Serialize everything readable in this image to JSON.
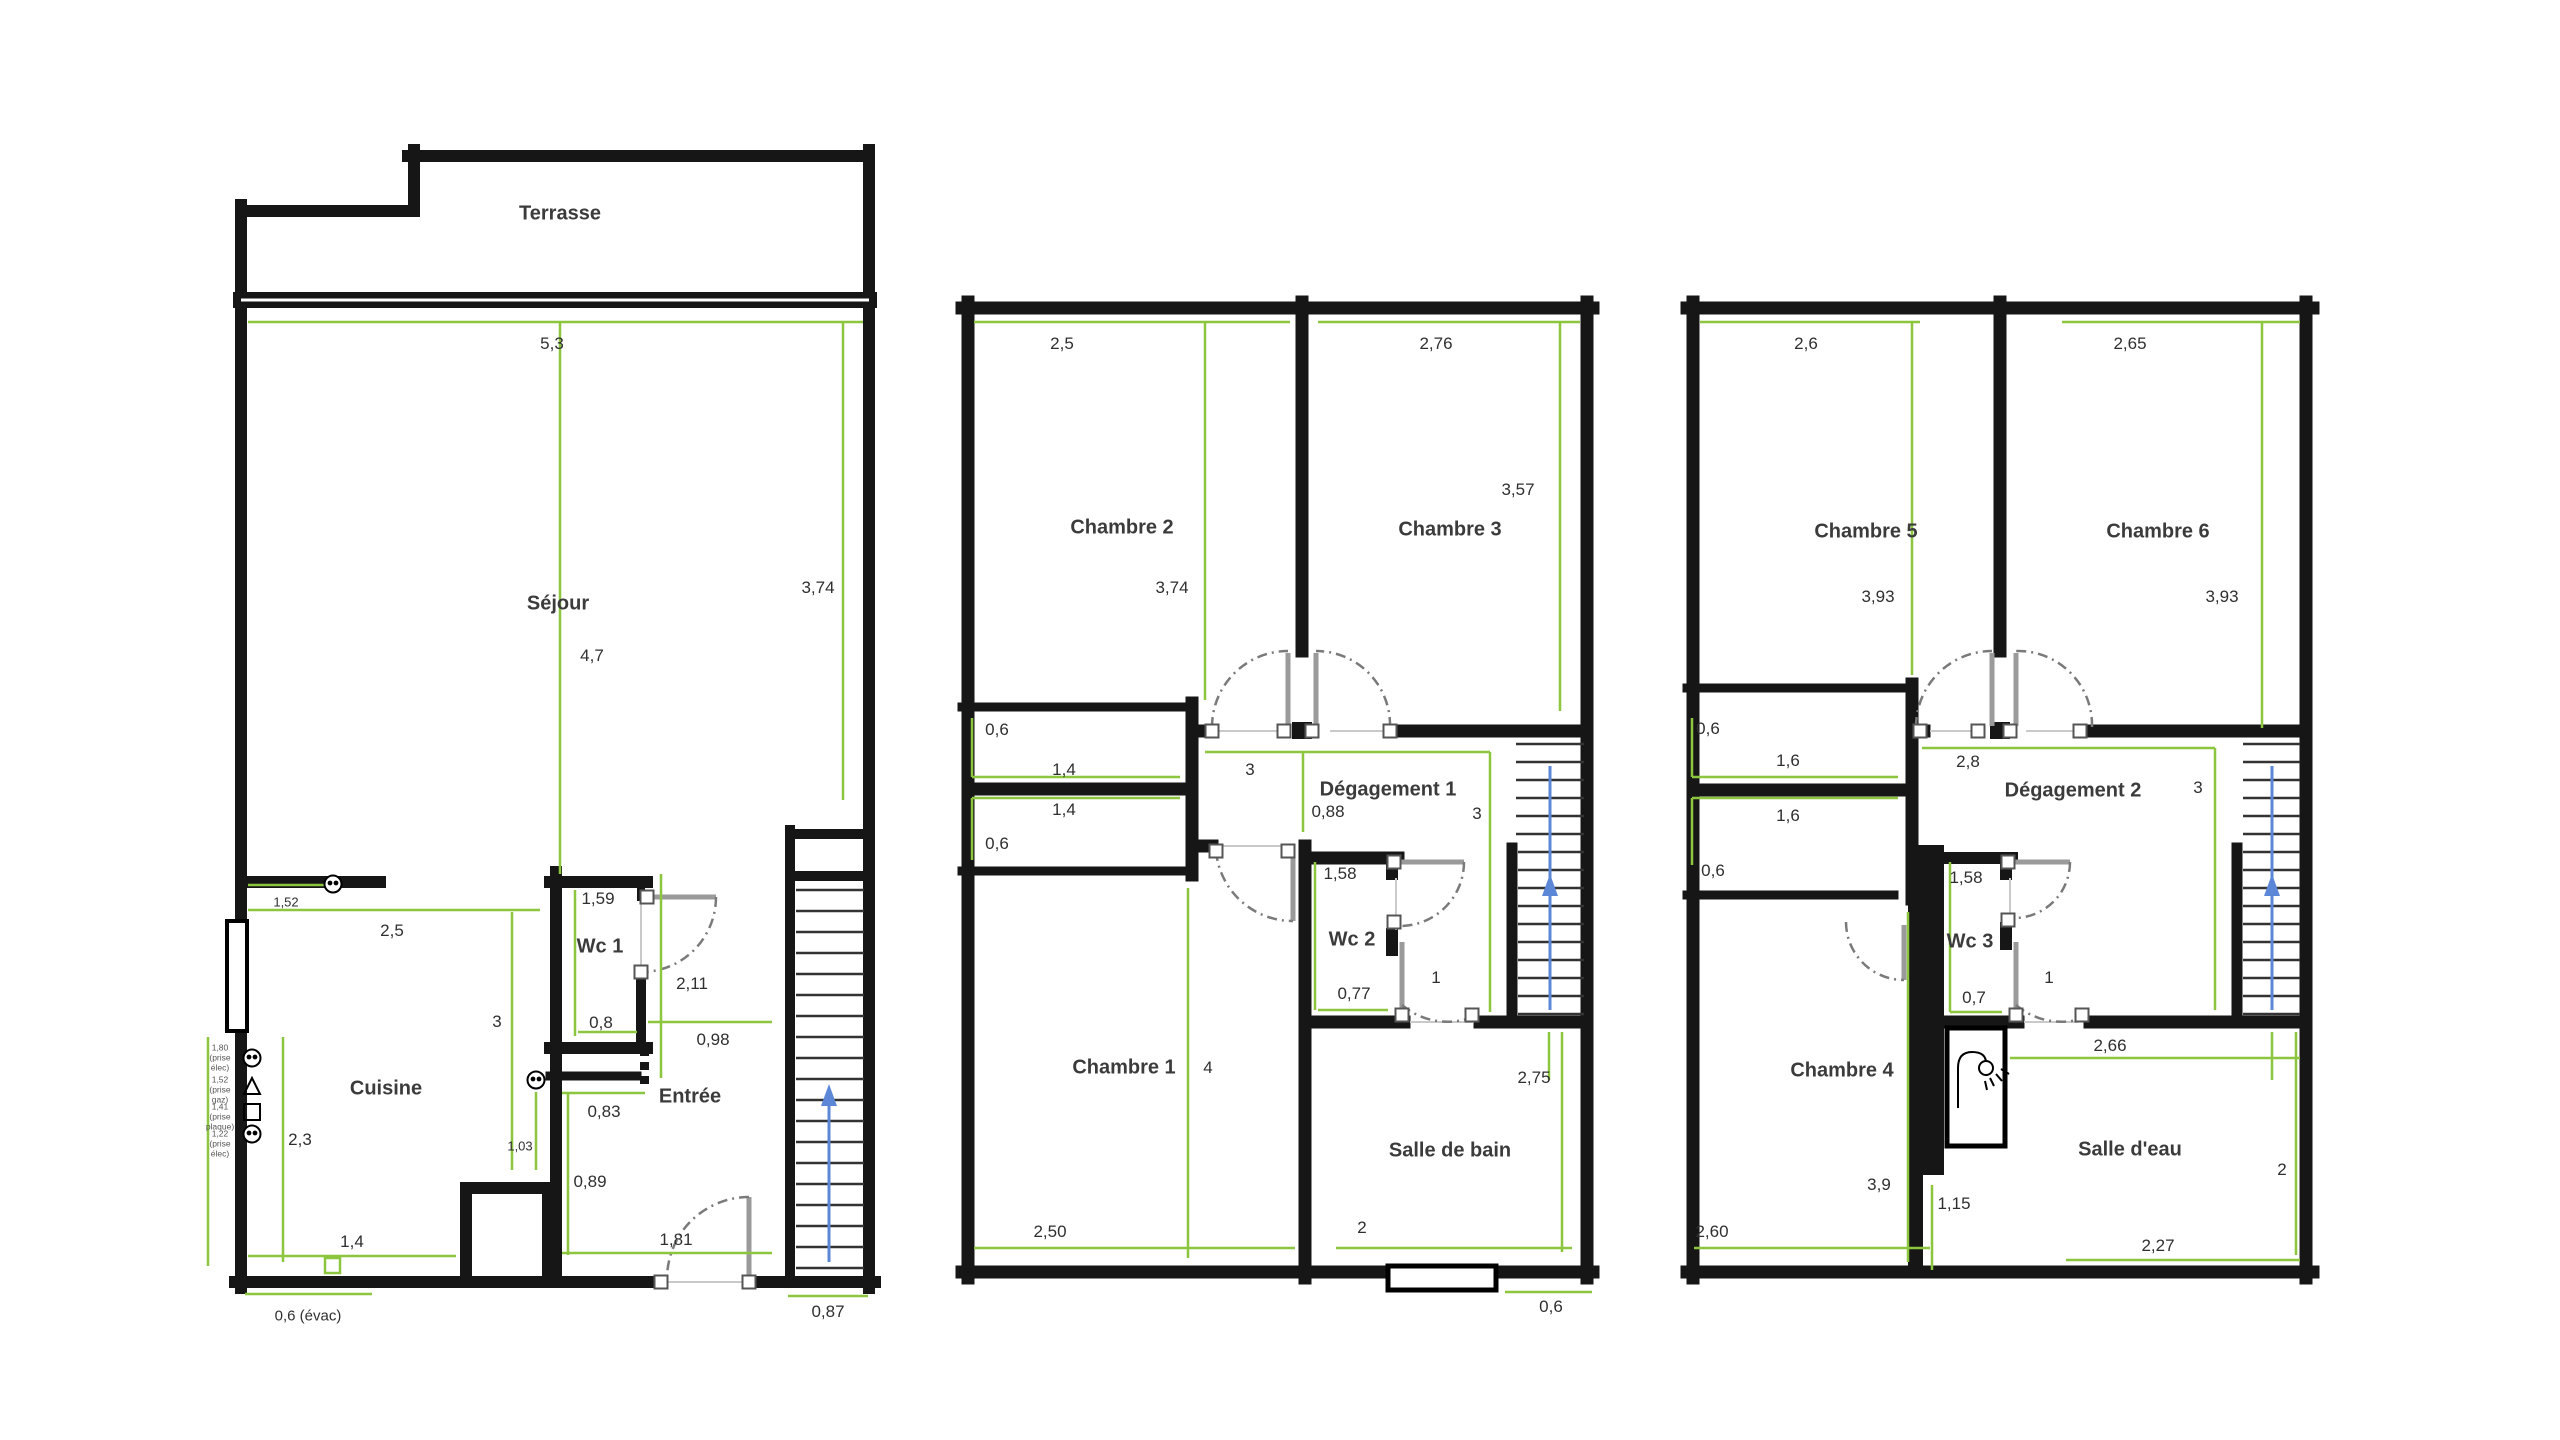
{
  "floors": {
    "ground": {
      "rooms": {
        "terrasse": "Terrasse",
        "sejour": "Séjour",
        "cuisine": "Cuisine",
        "wc1": "Wc 1",
        "entree": "Entrée"
      },
      "dims": {
        "top": "5,3",
        "sejour_height": "4,7",
        "right_height": "3,74",
        "counter": "1,52",
        "cuisine_width": "2,5",
        "cuisine_height": "3",
        "socket_height": "1,03",
        "cuisine_left": "2,3",
        "bottom_width": "1,4",
        "evac": "0,6 (évac)",
        "wc1_width": "1,59",
        "wc1_bottom": "0,8",
        "wc1_door": "2,11",
        "hall_width": "0,98",
        "entree_top": "0,83",
        "entree_side": "0,89",
        "entry_door": "1,81",
        "stairs_width": "0,87"
      },
      "outlets": {
        "o1": "1,80 (prise élec)",
        "o2": "1,52 (prise gaz)",
        "o3": "1,41 (prise plaque)",
        "o4": "1,22 (prise élec)"
      }
    },
    "first": {
      "rooms": {
        "chambre1": "Chambre 1",
        "chambre2": "Chambre 2",
        "chambre3": "Chambre 3",
        "degagement": "Dégagement 1",
        "wc": "Wc 2",
        "bath": "Salle de bain"
      },
      "dims": {
        "c2_width": "2,5",
        "c2_height": "3,74",
        "c3_width": "2,76",
        "c3_height": "3,57",
        "closet_up_depth": "0,6",
        "closet_up_width": "1,4",
        "closet_low_width": "1,4",
        "closet_low_depth": "0,6",
        "deg_width": "3",
        "deg_axis": "0,88",
        "deg_height": "3",
        "wc_height": "1,58",
        "wc_width": "0,77",
        "wc_door": "1",
        "c1_height": "4",
        "c1_width": "2,50",
        "sdb_width": "2",
        "sdb_height": "2,75",
        "window": "0,6"
      }
    },
    "second": {
      "rooms": {
        "chambre4": "Chambre 4",
        "chambre5": "Chambre 5",
        "chambre6": "Chambre 6",
        "degagement": "Dégagement 2",
        "wc": "Wc 3",
        "bath": "Salle d'eau"
      },
      "dims": {
        "c5_width": "2,6",
        "c5_height": "3,93",
        "c6_width": "2,65",
        "c6_height": "3,93",
        "closet_up_depth": "0,6",
        "closet_up_width": "1,6",
        "closet_low_width": "1,6",
        "closet_low_depth": "0,6",
        "deg_width": "2,8",
        "deg_height": "3",
        "wc_height": "1,58",
        "wc_width": "0,7",
        "wc_door": "1",
        "shower_width": "2,66",
        "c4_height": "3,9",
        "duct": "1,15",
        "c4_width": "2,60",
        "sde_height": "2",
        "sde_width": "2,27"
      }
    }
  },
  "colors": {
    "wall": "#161616",
    "dimension_line": "#8cc63e",
    "stairs_arrow": "#5b87d6",
    "door": "#9a9a9a"
  }
}
